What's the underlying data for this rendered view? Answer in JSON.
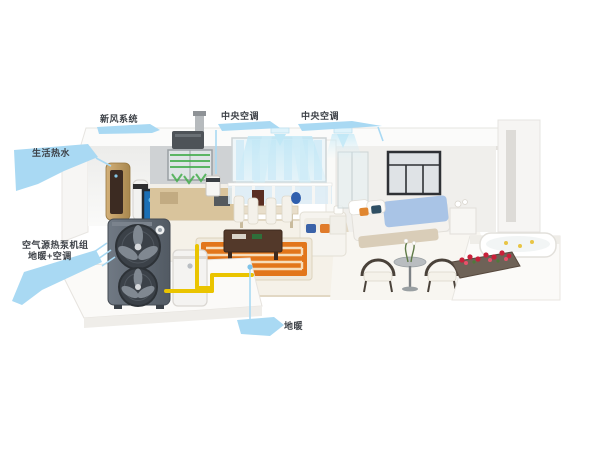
{
  "title": "whole-house air-source heat pump system cutaway",
  "callouts": {
    "fresh_air": {
      "label": "新风系统"
    },
    "ac_living": {
      "label": "中央空调"
    },
    "ac_bedroom": {
      "label": "中央空调"
    },
    "hot_water": {
      "label": "生活热水"
    },
    "heat_pump_unit": {
      "line1": "空气源热泵机组",
      "line2": "地暖+空调"
    },
    "floor_heating": {
      "label": "地暖"
    }
  },
  "colors": {
    "callout_blue": "#a9d9f3",
    "label_text": "#3d4147",
    "pipe_yellow": "#eac400",
    "floor_coil_orange": "#e2761b",
    "fresh_air_green": "#45ad4d",
    "cool_air_cyan": "#bfe7f6",
    "heat_pump_body": "#636b74",
    "water_heater_gold": "#c3a06b",
    "bed_blue": "#a9c4e6",
    "flower_red": "#c9203a"
  }
}
